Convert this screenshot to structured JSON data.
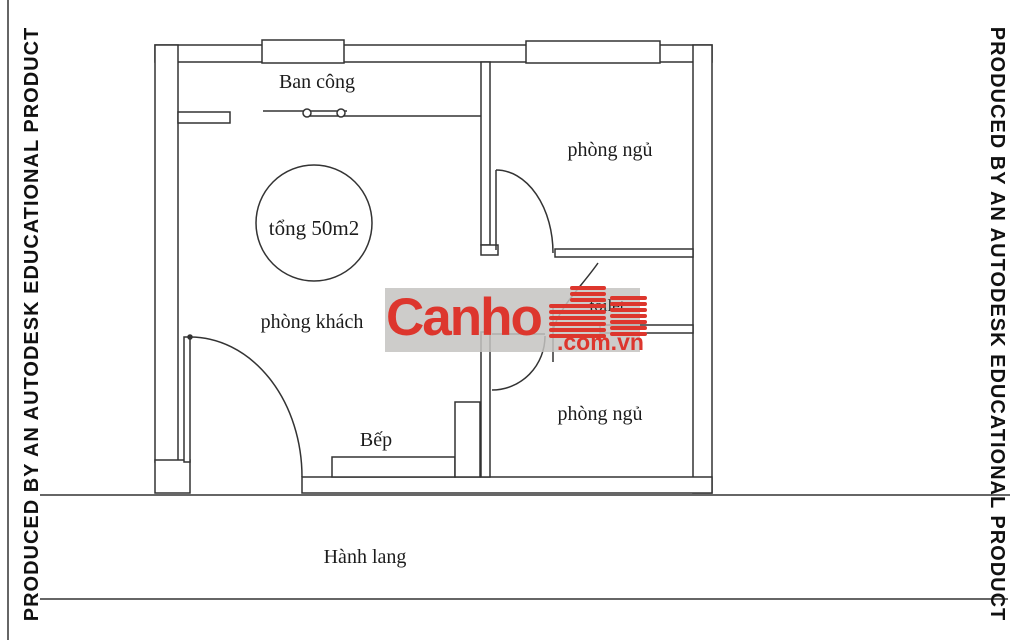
{
  "frame": {
    "left_watermark": "PRODUCED BY AN AUTODESK EDUCATIONAL PRODUCT",
    "right_watermark": "PRODUCED BY AN AUTODESK EDUCATIONAL PRODUCT"
  },
  "floor_plan": {
    "labels": {
      "balcony": "Ban công",
      "bedroom_top": "phòng ngủ",
      "total_area": "tổng 50m2",
      "living_room": "phòng khách",
      "kitchen": "Bếp",
      "bedroom_bottom": "phòng ngủ",
      "toilet": "toilet",
      "hallway": "Hành lang"
    }
  },
  "brand_watermark": {
    "name": "Canho",
    "suffix": ".com.vn",
    "accent_color": "#dd362d",
    "band_color": "#c4c3c1"
  },
  "colors": {
    "line": "#333333",
    "background": "#ffffff"
  }
}
